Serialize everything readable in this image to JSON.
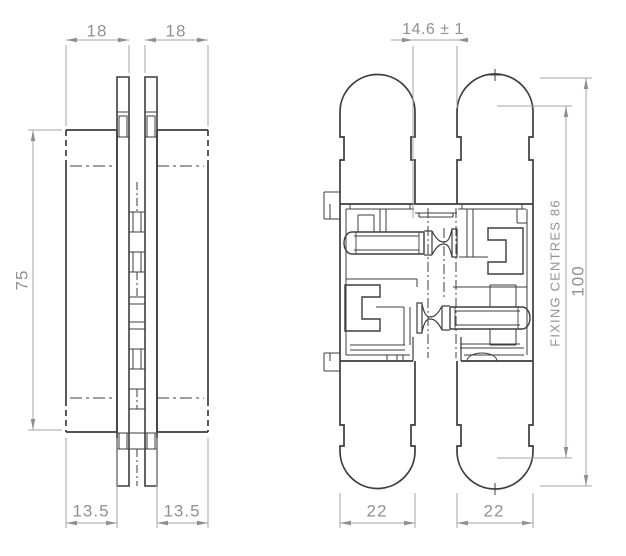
{
  "drawing": {
    "title": "concealed-hinge-technical-drawing",
    "left_view": {
      "dim_width_left": "18",
      "dim_width_right": "18",
      "dim_height": "75",
      "dim_arm_left": "13.5",
      "dim_arm_right": "13.5"
    },
    "right_view": {
      "dim_gap": "14.6 ± 1",
      "dim_fixing_centres": "FIXING CENTRES 86",
      "dim_height": "100",
      "dim_width_left": "22",
      "dim_width_right": "22"
    },
    "colors": {
      "line": "#3d3d3d",
      "dim_line": "#a6a6a6",
      "dim_text": "#919191"
    }
  }
}
